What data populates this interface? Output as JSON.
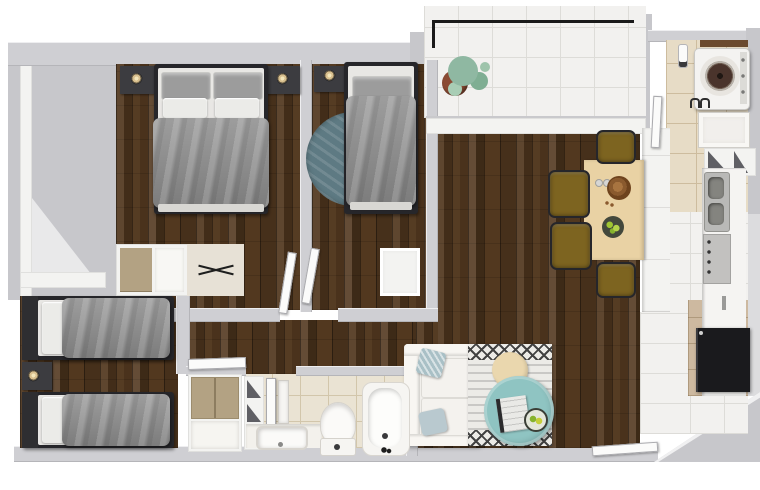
{
  "scene": {
    "type": "3d-floor-plan-render",
    "description": "Top-down 3D architectural render of a two-bedroom-plus-twin apartment with balcony, kitchen corridor, laundry nook, bathroom, and open living-dining area. No text labels are visible in the image.",
    "rooms": [
      {
        "name": "bedroom-double",
        "furniture": [
          "double-bed",
          "nightstand-left with table-lamp",
          "nightstand-right with table-lamp",
          "dresser-desk with x-decor"
        ]
      },
      {
        "name": "bedroom-single",
        "furniture": [
          "single-bed",
          "nightstand with table-lamp",
          "round-teal-rug",
          "white-cabinet"
        ]
      },
      {
        "name": "bedroom-twin",
        "furniture": [
          "twin-bed-upper",
          "twin-bed-lower",
          "shared-nightstand with table-lamp",
          "window-sill"
        ]
      },
      {
        "name": "living-dining",
        "furniture": [
          "white-sofa with two blue pillows",
          "patterned-area-rug",
          "teal-coffee-table with book and fruit bowl",
          "round-wood-side-table",
          "dining-table with bread bowl, glasses, fruit bowl",
          "dining-chair x4 (olive)"
        ]
      },
      {
        "name": "kitchen",
        "furniture": [
          "counter-run",
          "stainless-double-sink",
          "cooktop-oven with knobs",
          "black-desk"
        ]
      },
      {
        "name": "laundry-nook",
        "furniture": [
          "top-load-washing-machine",
          "laundry-sink",
          "open-shelf",
          "wall-hooks"
        ]
      },
      {
        "name": "bathroom",
        "furniture": [
          "vanity-counter with basin",
          "toilet",
          "bathtub",
          "open-shelf-column",
          "tan-wardrobe",
          "towel"
        ]
      },
      {
        "name": "balcony",
        "furniture": [
          "potted-monstera-plant",
          "black-railing"
        ]
      }
    ],
    "doors": [
      "bedroom-double-door",
      "bedroom-single-door",
      "twin-bedroom-door",
      "bathroom-door",
      "laundry-door",
      "entry-door"
    ],
    "palette": {
      "exterior": "#c7c7cb",
      "wall": "#cfcfd3",
      "wall_white": "#f3f3f1",
      "wood_mid": "#52381f",
      "tile_white": "#f2f1ef",
      "tile_grout": "#dddcd8",
      "tile_beige": "#e7dcc6",
      "beige_grout": "#cdbc9e",
      "bedding": "#8d8d8d",
      "pillow_light": "#ebebe8",
      "frame_dark": "#26262a",
      "nightstand": "#3c3c40",
      "lamp_gold": "#d8bf8e",
      "rug_round": "#5e7a83",
      "sofa_white": "#f1efeb",
      "pillow_blue": "#a9c0c6",
      "rug_area": "#ecebe7",
      "rug_pattern": "#424242",
      "coffee_teal": "#8fc4c2",
      "side_wood": "#ead7ae",
      "table_wood": "#e9d2a4",
      "chair_olive": "#7d6420",
      "plant_green": "#8fb8a2",
      "pot_brown": "#8a4a33",
      "appliance": "#f4f3f1",
      "drum_brown": "#4a342c",
      "desk_black": "#1a1a1d",
      "steel": "#b9b9b7",
      "wardrobe_tan": "#b3a283",
      "shelf_tri": "#5f5f64",
      "tan_floor": "#cdb9a0"
    }
  }
}
